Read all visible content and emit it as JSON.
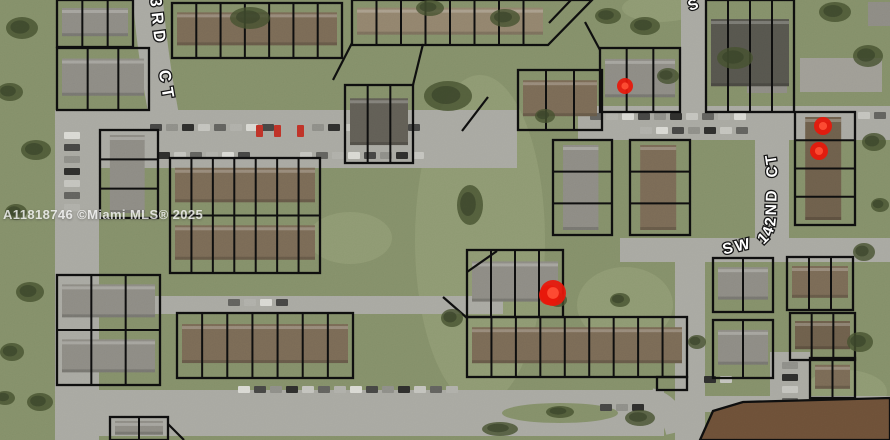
{
  "watermark": {
    "text": "A11818746 ©Miami MLS® 2025"
  },
  "street_labels": [
    {
      "name": "street-label-143rd-ct",
      "text": "3RD CT",
      "path": "M150,-4 Q155,58 168,124",
      "size": 16.5,
      "spacing": 6,
      "word_spacing": 12
    },
    {
      "name": "street-label-sw-142nd-ct",
      "text": "SW 142ND CT",
      "path": "M722,255 L756,247 Q775,243 776,216 L777,172 Q777,140 756,114",
      "size": 15.5,
      "spacing": 2.4,
      "word_spacing": 4
    }
  ],
  "partial_label": {
    "name": "street-label-partial-s",
    "text": "S",
    "x": 690,
    "y": 11,
    "size": 15,
    "rotate": -20
  },
  "markers": [
    {
      "x": 625,
      "y": 86,
      "r": 8,
      "blob": false
    },
    {
      "x": 823,
      "y": 126,
      "r": 9,
      "blob": false
    },
    {
      "x": 819,
      "y": 151,
      "r": 9,
      "blob": false
    },
    {
      "x": 553,
      "y": 293,
      "r": 13,
      "blob": true
    }
  ],
  "colors": {
    "grass_base": "#85906a",
    "grass_light": "#9aa37c",
    "tree": "#46512f",
    "tree_dark": "#39432a",
    "road": "#a9a9a2",
    "outline": "#0e0e0e",
    "marker": "#e8170a",
    "marker_bright": "#ff4f35",
    "red_car": "#c03328"
  },
  "roads": [
    {
      "t": "s",
      "d": "M147,-10 Q153,62 166,126",
      "w": 30
    },
    {
      "t": "r",
      "x": 55,
      "y": 110,
      "w": 462,
      "h": 58
    },
    {
      "t": "r",
      "x": 55,
      "y": 112,
      "w": 44,
      "h": 328
    },
    {
      "t": "r",
      "x": 55,
      "y": 296,
      "w": 448,
      "h": 18
    },
    {
      "t": "r",
      "x": 58,
      "y": 390,
      "w": 606,
      "h": 46
    },
    {
      "t": "s",
      "d": "M650,400 Q672,406 678,432",
      "w": 24
    },
    {
      "t": "r",
      "x": 578,
      "y": 106,
      "w": 312,
      "h": 34
    },
    {
      "t": "r",
      "x": 681,
      "y": 0,
      "w": 26,
      "h": 112
    },
    {
      "t": "r",
      "x": 755,
      "y": 108,
      "w": 34,
      "h": 142
    },
    {
      "t": "r",
      "x": 620,
      "y": 238,
      "w": 270,
      "h": 24
    },
    {
      "t": "r",
      "x": 675,
      "y": 240,
      "w": 30,
      "h": 200
    },
    {
      "t": "r",
      "x": 770,
      "y": 352,
      "w": 40,
      "h": 88
    },
    {
      "t": "r",
      "x": 700,
      "y": 396,
      "w": 190,
      "h": 16
    }
  ],
  "island": {
    "cx": 560,
    "cy": 413,
    "rx": 58,
    "ry": 10
  },
  "parcel_blocks": [
    {
      "x": 57,
      "y": 0,
      "w": 76,
      "h": 47,
      "cols": 3,
      "roof": "#8e8c85"
    },
    {
      "x": 172,
      "y": 3,
      "w": 170,
      "h": 55,
      "cols": 7,
      "roof": "#7b6b56"
    },
    {
      "x": 352,
      "y": 0,
      "w": 196,
      "h": 45,
      "cols": 8,
      "cut": 44,
      "roof": "#93856e"
    },
    {
      "x": 57,
      "y": 48,
      "w": 92,
      "h": 62,
      "cols": 3,
      "roof": "#8e8c85"
    },
    {
      "x": 100,
      "y": 130,
      "w": 58,
      "h": 88,
      "rows": 3,
      "roof": "#8e8c85"
    },
    {
      "x": 170,
      "y": 158,
      "w": 150,
      "h": 115,
      "cols": 7,
      "rows": 2,
      "roof": "#7b6b56"
    },
    {
      "x": 345,
      "y": 85,
      "w": 68,
      "h": 78,
      "cols": 3,
      "roof": "#625f56"
    },
    {
      "x": 518,
      "y": 70,
      "w": 84,
      "h": 60,
      "cols": 3,
      "roof": "#7b6b56"
    },
    {
      "x": 600,
      "y": 48,
      "w": 80,
      "h": 64,
      "cols": 3,
      "roof": "#8e8c85"
    },
    {
      "x": 706,
      "y": 0,
      "w": 88,
      "h": 112,
      "cols": 4,
      "roof": "#57564e"
    },
    {
      "x": 795,
      "y": 112,
      "w": 60,
      "h": 113,
      "rows": 4,
      "roof": "#6f604c"
    },
    {
      "x": 57,
      "y": 275,
      "w": 103,
      "h": 110,
      "cols": 3,
      "rows": 2,
      "roof": "#8e8c85"
    },
    {
      "x": 177,
      "y": 313,
      "w": 176,
      "h": 65,
      "cols": 7,
      "roof": "#7b6b56"
    },
    {
      "x": 467,
      "y": 250,
      "w": 96,
      "h": 67,
      "cols": 4,
      "roof": "#8e8c85"
    },
    {
      "x": 467,
      "y": 317,
      "w": 220,
      "h": 60,
      "cols": 9,
      "roof": "#7b6b56"
    },
    {
      "x": 657,
      "y": 377,
      "w": 30,
      "h": 13,
      "cols": 1,
      "roof": null
    },
    {
      "x": 553,
      "y": 140,
      "w": 59,
      "h": 95,
      "rows": 3,
      "roof": "#8e8c85"
    },
    {
      "x": 630,
      "y": 140,
      "w": 60,
      "h": 95,
      "rows": 3,
      "roof": "#7b6b56"
    },
    {
      "x": 713,
      "y": 258,
      "w": 60,
      "h": 54,
      "cols": 2,
      "roof": "#8e8c85"
    },
    {
      "x": 787,
      "y": 257,
      "w": 66,
      "h": 53,
      "cols": 3,
      "roof": "#7b6b56"
    },
    {
      "x": 713,
      "y": 320,
      "w": 60,
      "h": 58,
      "cols": 2,
      "roof": "#8e8c85"
    },
    {
      "x": 790,
      "y": 313,
      "w": 65,
      "h": 47,
      "cols": 3,
      "roof": "#6f604c"
    },
    {
      "x": 110,
      "y": 417,
      "w": 58,
      "h": 23,
      "cols": 2,
      "roof": "#8e8c85"
    },
    {
      "x": 810,
      "y": 358,
      "w": 45,
      "h": 40,
      "cols": 2,
      "roof": "#7b6b56"
    },
    {
      "poly": [
        [
          700,
          440
        ],
        [
          713,
          411
        ],
        [
          743,
          402
        ],
        [
          890,
          398
        ],
        [
          890,
          440
        ]
      ],
      "roof": "#6e5138"
    }
  ],
  "extra_lines": [
    [
      [
        333,
        80
      ],
      [
        352,
        43
      ]
    ],
    [
      [
        413,
        85
      ],
      [
        423,
        44
      ]
    ],
    [
      [
        488,
        97
      ],
      [
        462,
        131
      ]
    ],
    [
      [
        443,
        297
      ],
      [
        467,
        318
      ]
    ],
    [
      [
        467,
        272
      ],
      [
        497,
        251
      ]
    ],
    [
      [
        585,
        22
      ],
      [
        600,
        50
      ]
    ],
    [
      [
        571,
        0
      ],
      [
        549,
        23
      ]
    ],
    [
      [
        168,
        424
      ],
      [
        184,
        440
      ]
    ]
  ],
  "extra_buildings": [
    {
      "x": 800,
      "y": 58,
      "w": 82,
      "h": 34,
      "roof": "#a09e96"
    },
    {
      "x": 747,
      "y": 73,
      "w": 40,
      "h": 20,
      "roof": "#8e8c85"
    },
    {
      "x": 868,
      "y": 2,
      "w": 22,
      "h": 24,
      "roof": "#8e8c85"
    }
  ],
  "car_rows": [
    {
      "x": 64,
      "y": 132,
      "n": 7,
      "vert": true
    },
    {
      "x": 150,
      "y": 124,
      "n": 8,
      "vert": false
    },
    {
      "x": 312,
      "y": 124,
      "n": 7,
      "vert": false
    },
    {
      "x": 158,
      "y": 152,
      "n": 6,
      "vert": false
    },
    {
      "x": 300,
      "y": 152,
      "n": 8,
      "vert": false
    },
    {
      "x": 590,
      "y": 113,
      "n": 10,
      "vert": false
    },
    {
      "x": 640,
      "y": 127,
      "n": 7,
      "vert": false
    },
    {
      "x": 238,
      "y": 386,
      "n": 14,
      "vert": false
    },
    {
      "x": 600,
      "y": 404,
      "n": 3,
      "vert": false
    },
    {
      "x": 782,
      "y": 362,
      "n": 6,
      "vert": true
    },
    {
      "x": 704,
      "y": 376,
      "n": 2,
      "vert": false
    },
    {
      "x": 858,
      "y": 112,
      "n": 2,
      "vert": false
    },
    {
      "x": 228,
      "y": 299,
      "n": 4,
      "vert": false
    }
  ],
  "red_cars": [
    {
      "x": 256,
      "y": 125
    },
    {
      "x": 274,
      "y": 125
    },
    {
      "x": 297,
      "y": 125
    }
  ],
  "field_patches": [
    {
      "cx": 480,
      "cy": 240,
      "rx": 65,
      "ry": 165
    },
    {
      "cx": 350,
      "cy": 238,
      "rx": 42,
      "ry": 26
    },
    {
      "cx": 625,
      "cy": 305,
      "rx": 48,
      "ry": 38
    },
    {
      "cx": 845,
      "cy": 392,
      "rx": 42,
      "ry": 22
    },
    {
      "cx": 660,
      "cy": 8,
      "rx": 38,
      "ry": 14
    }
  ],
  "trees": [
    [
      22,
      28,
      16,
      11
    ],
    [
      10,
      92,
      13,
      9
    ],
    [
      36,
      150,
      15,
      10
    ],
    [
      16,
      212,
      11,
      8
    ],
    [
      30,
      292,
      14,
      10
    ],
    [
      12,
      352,
      12,
      9
    ],
    [
      40,
      402,
      13,
      9
    ],
    [
      5,
      398,
      10,
      7
    ],
    [
      250,
      18,
      20,
      11
    ],
    [
      505,
      18,
      15,
      9
    ],
    [
      448,
      96,
      24,
      15
    ],
    [
      470,
      205,
      13,
      20
    ],
    [
      452,
      318,
      11,
      9
    ],
    [
      500,
      429,
      18,
      7
    ],
    [
      558,
      300,
      9,
      7
    ],
    [
      868,
      56,
      15,
      11
    ],
    [
      874,
      142,
      12,
      9
    ],
    [
      864,
      252,
      11,
      9
    ],
    [
      860,
      342,
      13,
      10
    ],
    [
      880,
      205,
      9,
      7
    ],
    [
      640,
      418,
      15,
      8
    ],
    [
      697,
      342,
      9,
      7
    ],
    [
      608,
      16,
      13,
      8
    ],
    [
      645,
      26,
      15,
      9
    ],
    [
      668,
      76,
      11,
      8
    ],
    [
      735,
      58,
      18,
      11
    ],
    [
      835,
      12,
      16,
      10
    ],
    [
      620,
      300,
      10,
      7
    ],
    [
      545,
      116,
      10,
      7
    ],
    [
      430,
      8,
      14,
      8
    ],
    [
      560,
      412,
      14,
      6
    ]
  ]
}
